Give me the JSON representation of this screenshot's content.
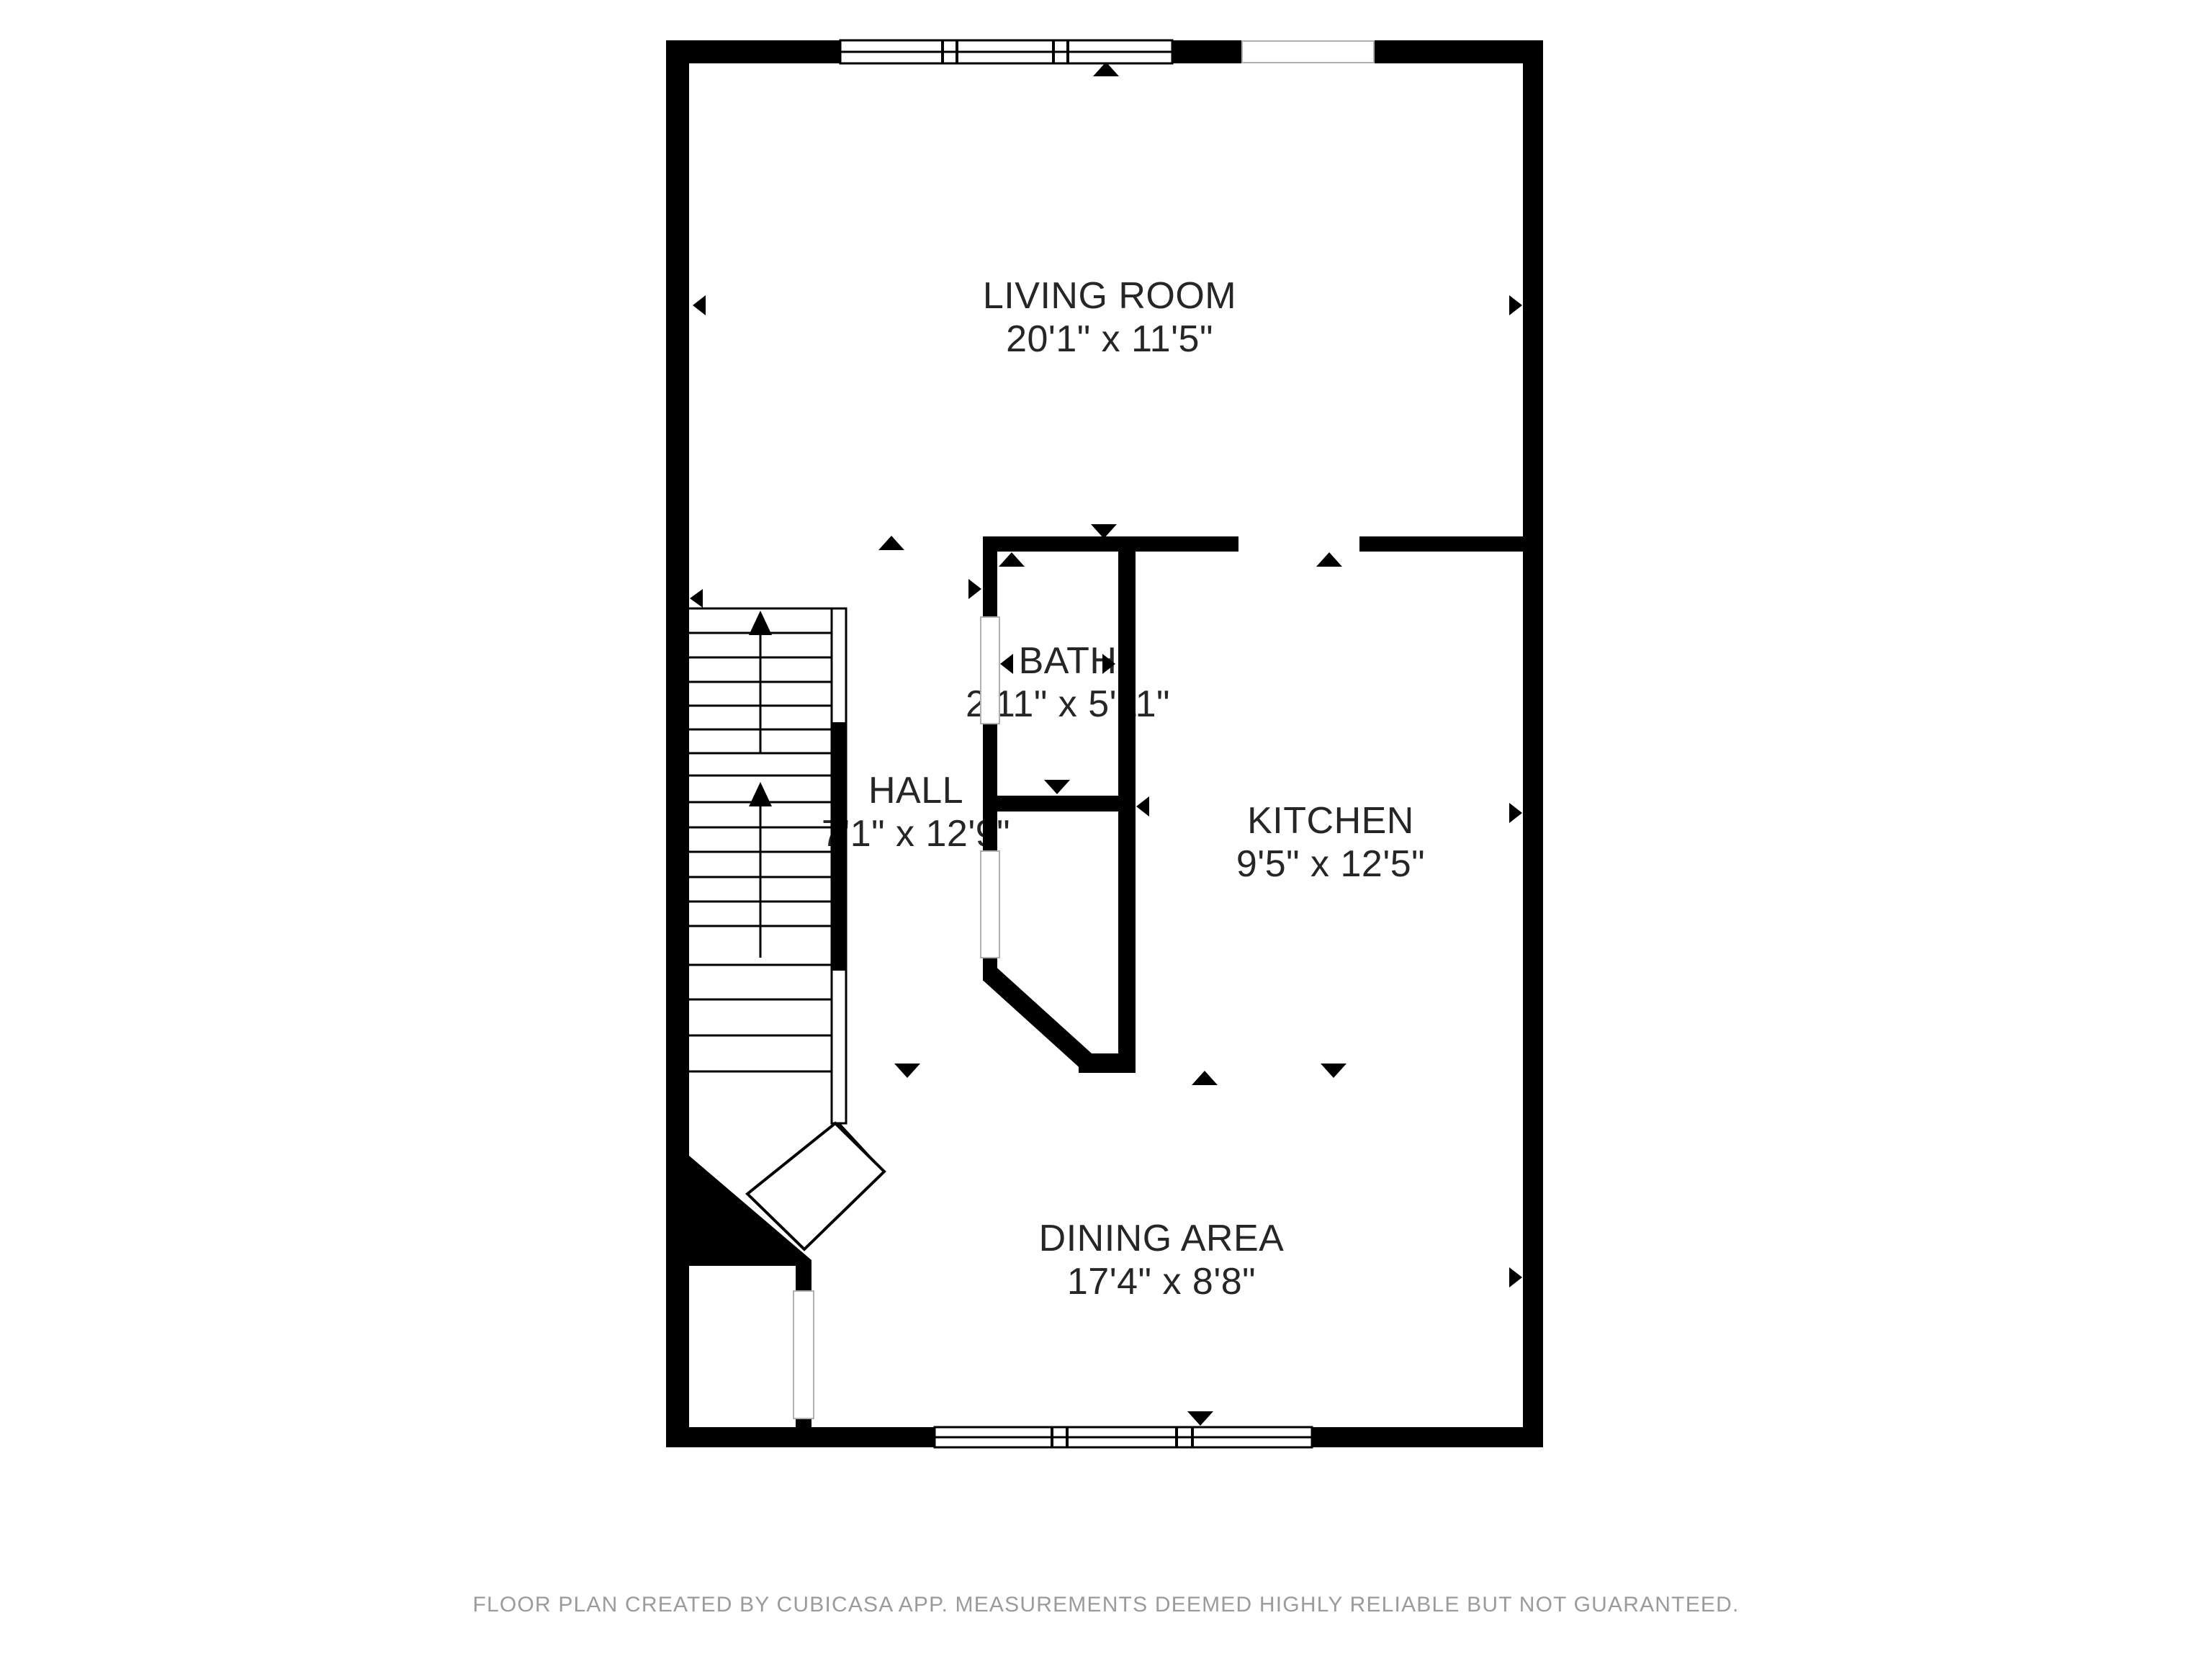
{
  "rooms": [
    {
      "id": "living-room",
      "name": "LIVING ROOM",
      "dimensions": "20'1\" x 11'5\""
    },
    {
      "id": "bath",
      "name": "BATH",
      "dimensions": "2'11\" x 5'11\""
    },
    {
      "id": "hall",
      "name": "HALL",
      "dimensions": "7'1\" x 12'9\""
    },
    {
      "id": "kitchen",
      "name": "KITCHEN",
      "dimensions": "9'5\" x 12'5\""
    },
    {
      "id": "dining-area",
      "name": "DINING AREA",
      "dimensions": "17'4\" x 8'8\""
    }
  ],
  "footer": {
    "disclaimer": "FLOOR PLAN CREATED BY CUBICASA APP. MEASUREMENTS DEEMED HIGHLY RELIABLE BUT NOT GUARANTEED."
  },
  "colors": {
    "wall": "#000000",
    "background": "#ffffff",
    "label": "#262626",
    "footer": "#9b9b9b"
  }
}
